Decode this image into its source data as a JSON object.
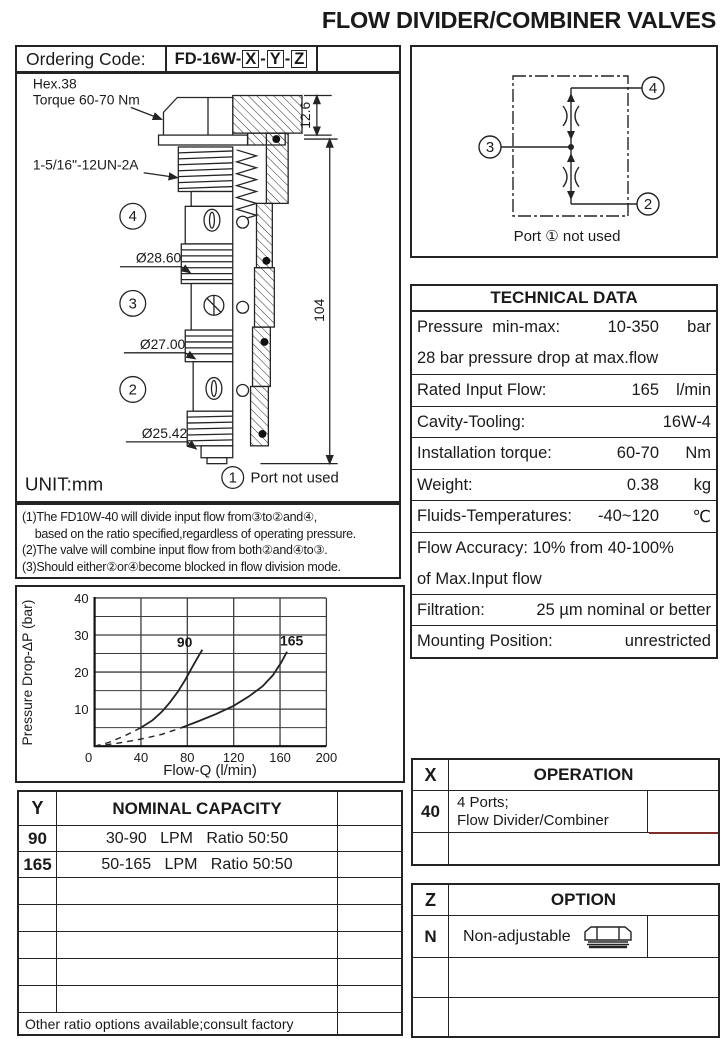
{
  "page": {
    "title": "FLOW DIVIDER/COMBINER VALVES"
  },
  "ordering": {
    "label": "Ordering Code:",
    "code_prefix": "FD-16W-",
    "boxed_letters": [
      "X",
      "Y",
      "Z"
    ],
    "separator": "-"
  },
  "drawing": {
    "hex_label_line1": "Hex.38",
    "hex_label_line2": "Torque 60-70 Nm",
    "thread_label": "1-5/16\"-12UN-2A",
    "dim_top": "12.6",
    "dim_height": "104",
    "dia_labels": [
      "Ø28.60",
      "Ø27.00",
      "Ø25.42"
    ],
    "port_labels": [
      "4",
      "3",
      "2"
    ],
    "bottom_port_num": "1",
    "bottom_port_text": "Port  not used",
    "unit": "UNIT:mm"
  },
  "schematic": {
    "port_top": "4",
    "port_left": "3",
    "port_bottom": "2",
    "caption": "Port ①  not used"
  },
  "notes": {
    "lines": [
      "(1)The FD10W-40 will divide input flow from③to②and④,",
      "    based on the ratio specified,regardless of operating pressure.",
      "(2)The valve will combine input flow from both②and④to③.",
      "(3)Should either②or④become blocked in flow division mode."
    ]
  },
  "technical": {
    "title": "TECHNICAL DATA",
    "rows": [
      {
        "label": "Pressure  min-max:",
        "value": "10-350",
        "unit": "bar",
        "line2": "28 bar pressure drop at max.flow"
      },
      {
        "label": "Rated Input Flow:",
        "value": "165",
        "unit": "l/min"
      },
      {
        "label": "Cavity-Tooling:",
        "value": "16W-4",
        "unit": ""
      },
      {
        "label": "Installation torque:",
        "value": "60-70",
        "unit": "Nm"
      },
      {
        "label": "Weight:",
        "value": "0.38",
        "unit": "kg"
      },
      {
        "label": "Fluids-Temperatures:",
        "value": "-40~120",
        "unit": "℃"
      },
      {
        "label": "Flow Accuracy: 10% from 40-100%",
        "value": "",
        "unit": "",
        "line2": "of Max.Input flow"
      },
      {
        "label": "Filtration:",
        "value": "25 µm nominal or better",
        "unit": ""
      },
      {
        "label": "Mounting Position:",
        "value": "unrestricted",
        "unit": ""
      }
    ]
  },
  "chart_data": {
    "type": "line",
    "title": "",
    "xlabel": "Flow-Q (l/min)",
    "ylabel": "Pressure Drop-ΔP (bar)",
    "xlim": [
      0,
      200
    ],
    "ylim": [
      0,
      40
    ],
    "x_ticks": [
      0,
      40,
      80,
      120,
      160,
      200
    ],
    "y_ticks": [
      10,
      20,
      30,
      40
    ],
    "y_minor_step": 5,
    "grid": true,
    "legend_position": "none",
    "series": [
      {
        "name": "90",
        "dashed": [
          [
            0,
            0
          ],
          [
            12,
            1
          ],
          [
            26,
            2.8
          ],
          [
            40,
            5
          ]
        ],
        "solid": [
          [
            40,
            5
          ],
          [
            50,
            7
          ],
          [
            58,
            9.3
          ],
          [
            65,
            11.8
          ],
          [
            72,
            14.8
          ],
          [
            78,
            17.8
          ],
          [
            84,
            21.2
          ],
          [
            90,
            24.5
          ],
          [
            93,
            26
          ]
        ],
        "label_pos": [
          71,
          26.8
        ]
      },
      {
        "name": "165",
        "dashed": [
          [
            0,
            0
          ],
          [
            20,
            0.8
          ],
          [
            40,
            1.9
          ],
          [
            58,
            3.2
          ],
          [
            75,
            5
          ]
        ],
        "solid": [
          [
            75,
            5
          ],
          [
            90,
            6.8
          ],
          [
            105,
            8.7
          ],
          [
            120,
            10.9
          ],
          [
            133,
            13.4
          ],
          [
            145,
            16.2
          ],
          [
            154,
            19.2
          ],
          [
            161,
            22.6
          ],
          [
            166,
            25.5
          ]
        ],
        "label_pos": [
          160,
          27.2
        ]
      }
    ]
  },
  "capacity_table": {
    "col1_header": "Y",
    "col2_header": "NOMINAL CAPACITY",
    "rows": [
      {
        "code": "90",
        "text": "30-90   LPM   Ratio 50:50"
      },
      {
        "code": "165",
        "text": "50-165   LPM   Ratio 50:50"
      }
    ],
    "empty_rows": 5,
    "footer": "Other ratio options available;consult factory"
  },
  "operation_table": {
    "col1_header": "X",
    "col2_header": "OPERATION",
    "rows": [
      {
        "code": "40",
        "lines": [
          "4 Ports;",
          "Flow Divider/Combiner"
        ]
      }
    ],
    "empty_rows": 1,
    "accent_color": "#7d2b2b"
  },
  "option_table": {
    "col1_header": "Z",
    "col2_header": "OPTION",
    "rows": [
      {
        "code": "N",
        "text": "Non-adjustable",
        "icon": "hex-plug"
      }
    ],
    "empty_rows": 2
  }
}
